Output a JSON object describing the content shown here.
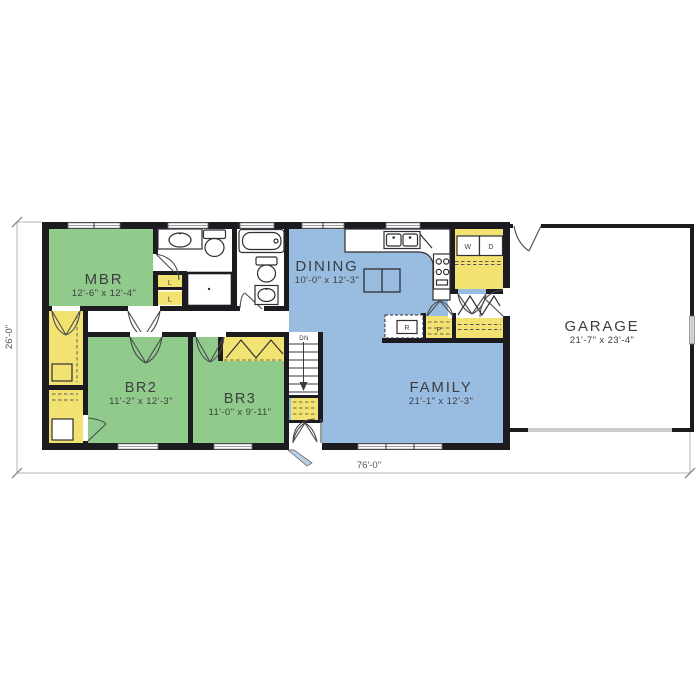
{
  "palette": {
    "bedroom_green": "#90cb8b",
    "living_blue": "#98bde0",
    "closet_yellow": "#f2e272",
    "wall_black": "#1b1b20",
    "door_leaf_blue": "#b9cfe3"
  },
  "rooms": [
    {
      "name": "MBR",
      "dims": "12'-6\" x 12'-4\""
    },
    {
      "name": "BR2",
      "dims": "11'-2\" x 12'-3\""
    },
    {
      "name": "BR3",
      "dims": "11'-0\" x 9'-11\""
    },
    {
      "name": "DINING",
      "dims": "10'-0\" x 12'-3\""
    },
    {
      "name": "FAMILY",
      "dims": "21'-1\" x 12'-3\""
    },
    {
      "name": "GARAGE",
      "dims": "21'-7\" x 23'-4\""
    }
  ],
  "fixtures": {
    "linen_closet": "L",
    "washer": "W",
    "dryer": "D",
    "refrigerator": "R",
    "pantry": "P",
    "stairs_down": "DN"
  },
  "overall_dimensions": {
    "width": "76'-0\"",
    "depth": "26'-0\""
  }
}
